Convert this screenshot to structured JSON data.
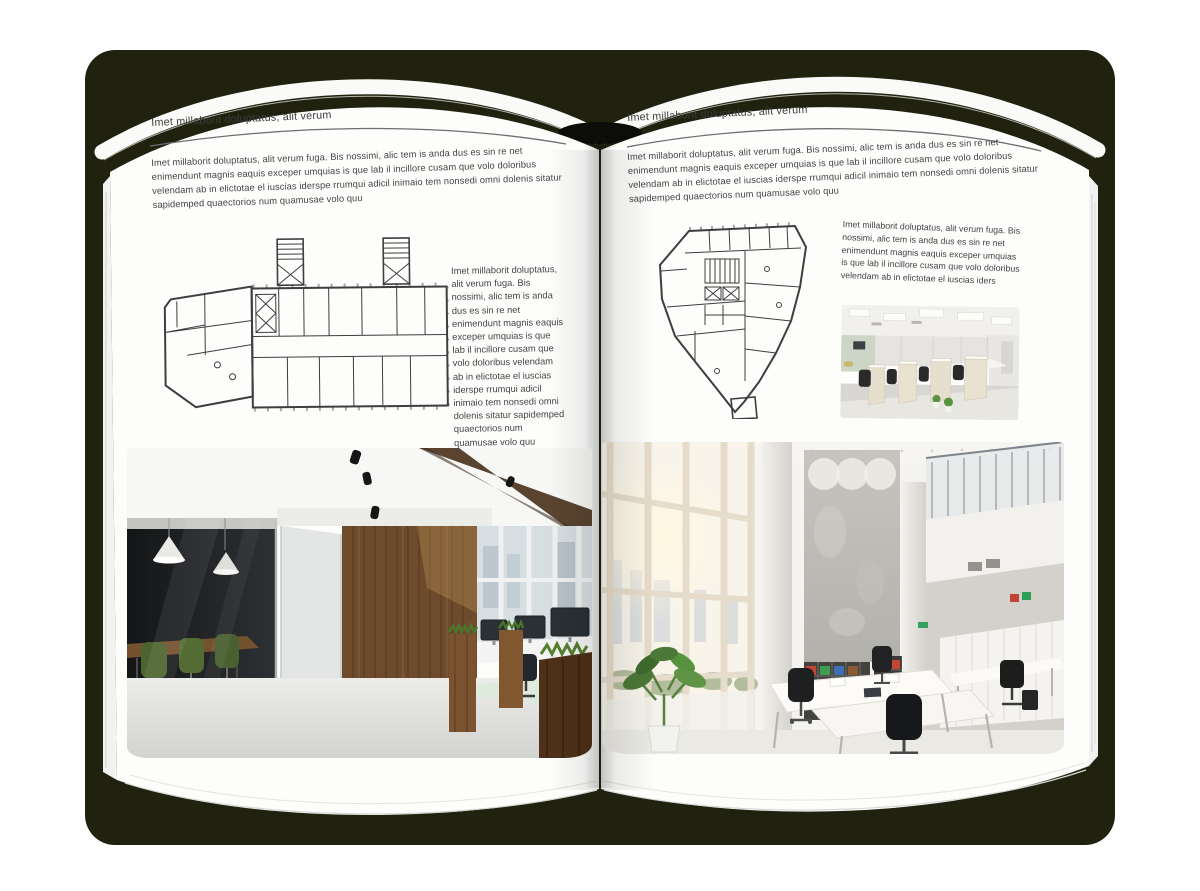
{
  "backdrop": {
    "color": "#20220f"
  },
  "book": {
    "left_page": {
      "header": "Imet millaborit doluptatus, alit verum",
      "intro": "Imet millaborit doluptatus, alit verum fuga. Bis nossimi, alic tem is anda dus es sin re net enimendunt magnis eaquis exceper umquias is que lab il incillore cusam que volo doloribus velendam ab in elictotae el iuscias iderspe rrumqui adicil inimaio tem nonsedi omni dolenis sitatur sapidemped quaectorios num quamusae volo quu",
      "side_text": "Imet millaborit doluptatus, alit verum fuga. Bis nossimi, alic tem is anda dus es sin re net enimendunt magnis eaquis exceper umquias is que lab il incillore cusam que volo doloribus velendam ab in elictotae el iuscias iderspe rrumqui adicil inimaio tem nonsedi omni dolenis sitatur sapidemped quaectorios num quamusae volo quu",
      "figures": {
        "floor_plan": "wide-office-building-floor-plan",
        "photo": "loft-office-interior-photo"
      }
    },
    "right_page": {
      "header": "Imet millaborit doluptatus, alit verum",
      "intro": "Imet millaborit doluptatus, alit verum fuga. Bis nossimi, alic tem is anda dus es sin re net enimendunt magnis eaquis exceper umquias is que lab il incillore cusam que volo doloribus velendam ab in elictotae el iuscias iderspe rrumqui adicil inimaio tem nonsedi omni dolenis sitatur sapidemped quaectorios num quamusae volo quu",
      "side_text": "Imet millaborit doluptatus, alit verum fuga. Bis nossimi, alic tem is anda dus es sin re net enimendunt magnis eaquis exceper umquias is que lab il incillore cusam que volo doloribus velendam ab in elictotae el iuscias iders",
      "figures": {
        "floor_plan": "irregular-tower-floor-plan",
        "photo_small": "open-plan-cubicle-office-photo",
        "photo_large": "bright-atrium-office-photo"
      }
    }
  }
}
